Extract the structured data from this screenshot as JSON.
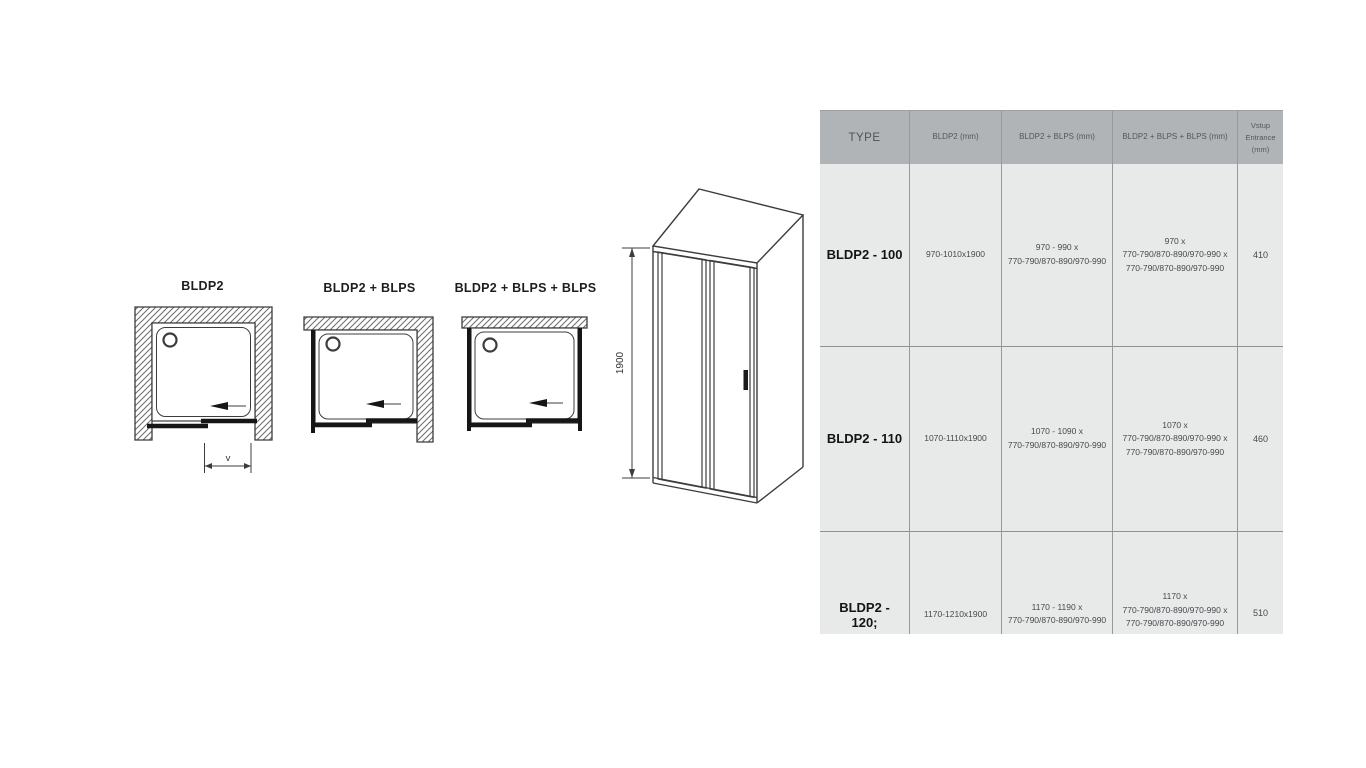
{
  "colors": {
    "drawing_line": "#3c3c3c",
    "door_line": "#161616",
    "table_header_bg": "#b1b4b6",
    "table_body_bg": "#e8e9e9",
    "grid_line": "#97999c",
    "row_separator": "#8f9294",
    "header_text": "#54575b",
    "cell_text": "#46494d",
    "type_text": "#141414"
  },
  "diagrams": {
    "plan_views": [
      {
        "label": "BLDP2",
        "width_dim_label": "v"
      },
      {
        "label": "BLDP2 + BLPS"
      },
      {
        "label": "BLDP2 + BLPS + BLPS"
      }
    ],
    "elevation": {
      "height_dim_label": "1900"
    }
  },
  "table": {
    "headers": {
      "type": "TYPE",
      "bldp2": "BLDP2 (mm)",
      "bldp2_blps": "BLDP2 + BLPS (mm)",
      "bldp2_blps_blps": "BLDP2 + BLPS + BLPS (mm)",
      "entrance": [
        "Vstup",
        "Entrance",
        "(mm)"
      ]
    },
    "rows": [
      {
        "type": "BLDP2 - 100",
        "bldp2": "970-1010x1900",
        "bldp2_blps": [
          "970 - 990 x",
          "770-790/870-890/970-990"
        ],
        "bldp2_blps_blps": [
          "970 x",
          "770-790/870-890/970-990 x",
          "770-790/870-890/970-990"
        ],
        "entrance": "410"
      },
      {
        "type": "BLDP2 - 110",
        "bldp2": "1070-1110x1900",
        "bldp2_blps": [
          "1070 - 1090 x",
          "770-790/870-890/970-990"
        ],
        "bldp2_blps_blps": [
          "1070 x",
          "770-790/870-890/970-990 x",
          "770-790/870-890/970-990"
        ],
        "entrance": "460"
      },
      {
        "type": "BLDP2 - 120;",
        "bldp2": "1170-1210x1900",
        "bldp2_blps": [
          "1170 - 1190 x",
          "770-790/870-890/970-990"
        ],
        "bldp2_blps_blps": [
          "1170 x",
          "770-790/870-890/970-990 x",
          "770-790/870-890/970-990"
        ],
        "entrance": "510"
      }
    ]
  }
}
